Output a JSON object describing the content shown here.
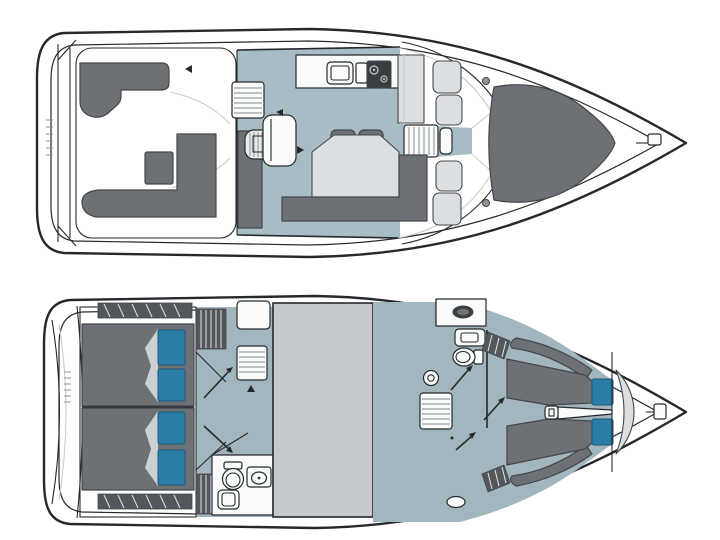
{
  "figure": {
    "kind": "boat-floorplan-diagram",
    "views": [
      {
        "id": "main-deck",
        "features": [
          "swim-platform",
          "aft-cockpit",
          "cockpit-l-seat-port",
          "cockpit-l-seat-starboard",
          "cockpit-table",
          "salon",
          "galley-counter",
          "galley-sink",
          "galley-stove",
          "tall-cabinet",
          "dinette-table",
          "dinette-seat-backs",
          "dinette-l-bench",
          "companionway-steps",
          "helm-console",
          "steering-wheel",
          "helm-seat",
          "windshield",
          "walkthrough-passage",
          "walkway-steps",
          "side-seat-panels",
          "bow-sunpad",
          "deck-hardware-dots",
          "bow-cleat"
        ]
      },
      {
        "id": "lower-deck",
        "features": [
          "swim-platform",
          "aft-cabin",
          "aft-berth-port",
          "aft-berth-starboard",
          "berth-pillows",
          "side-window-hatching",
          "wardrobe-cabinet",
          "companionway-steps",
          "aft-head",
          "toilet",
          "washbasin",
          "shower",
          "engine-compartment",
          "mid-corridor",
          "door-swing-arrows",
          "forward-head",
          "forward-toilet",
          "mirror-locker",
          "basin-counter",
          "porthole",
          "forward-steps",
          "bow-cabin",
          "v-berth-port",
          "v-berth-starboard",
          "v-berth-pillows",
          "center-handle",
          "side-shelves",
          "bow-seat-crescent",
          "bow-fitting",
          "deck-hatch-oval"
        ]
      }
    ]
  },
  "colors": {
    "outline": "#26292c",
    "outline_soft": "#43474b",
    "floor_main": "#a8bcc5",
    "floor_lower": "#a2b6bf",
    "furniture_dark": "#6d7175",
    "furniture_medium": "#90959a",
    "furniture_light": "#dcdfe1",
    "fixture_white": "#fafbfb",
    "stove_black": "#3a3e42",
    "pillow_teal": "#2a7da6",
    "pillow_edge": "#1c587a",
    "engine_gray": "#c6c9cb",
    "hatch_dark": "#53575b",
    "rib_light": "#9aa0a5",
    "seam": "#c9cdd0",
    "sheet_light": "#ccd0d3",
    "hull_white": "#ffffff"
  }
}
